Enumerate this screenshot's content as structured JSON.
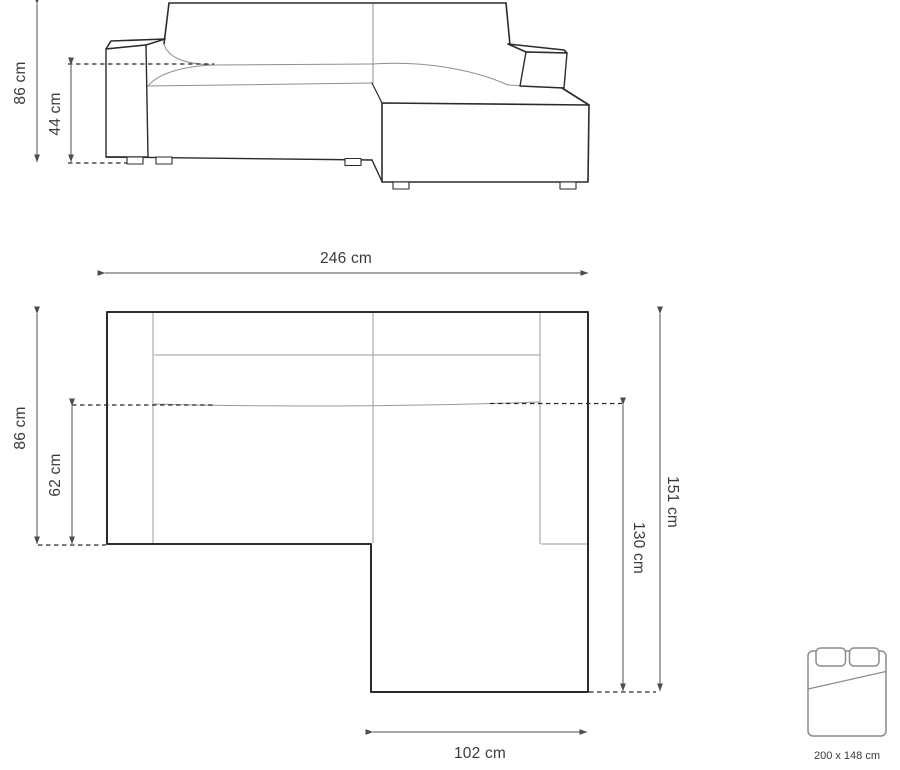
{
  "front_view": {
    "height_label": "86 cm",
    "seat_height_label": "44 cm"
  },
  "top_view": {
    "width_label": "246 cm",
    "depth_label": "86 cm",
    "seat_depth_label": "62 cm",
    "chaise_outer_label": "151 cm",
    "chaise_inner_label": "130 cm",
    "chaise_width_label": "102 cm"
  },
  "bed_icon": {
    "size_label": "200 x 148 cm"
  },
  "colors": {
    "background": "#ffffff",
    "sofa_outline": "#2b2b2b",
    "seam_line": "#8f8f8f",
    "plan_inner_line": "#9a9a9a",
    "dimension_line": "#4d4d4d",
    "label_text": "#3a3a3a",
    "bed_icon_stroke": "#8c8c8c"
  }
}
